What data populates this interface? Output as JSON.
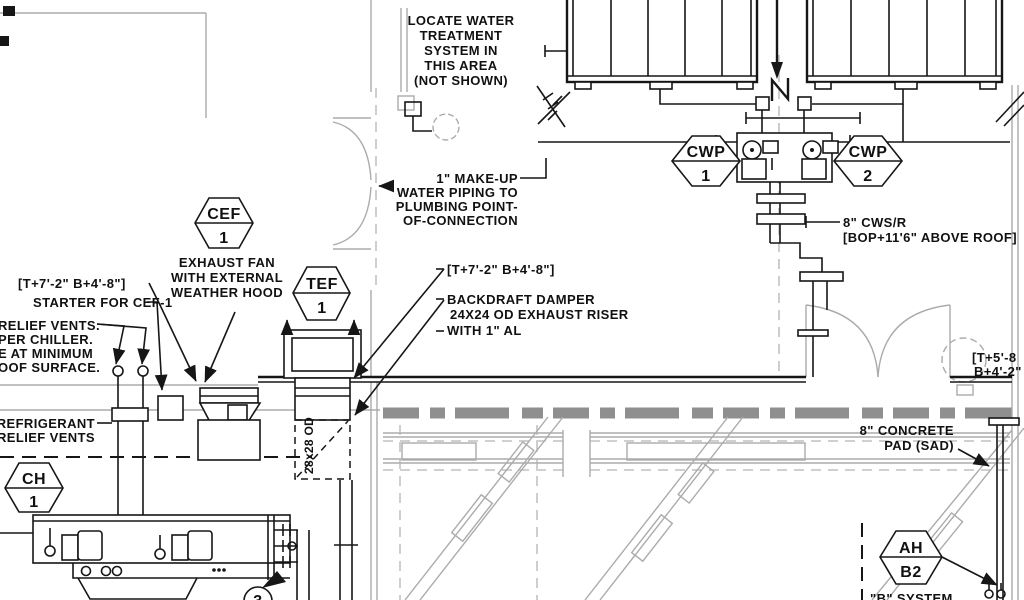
{
  "drawing_type": "mechanical-roof-plan",
  "colors": {
    "ink": "#161616",
    "arch_gray": "#ababab",
    "wall_gray": "#8f8f8f",
    "paper": "#ffffff"
  },
  "notes": {
    "locate": [
      "LOCATE WATER",
      "TREATMENT",
      "SYSTEM IN",
      "THIS AREA",
      "(NOT SHOWN)"
    ],
    "makeup": [
      "1\" MAKE-UP",
      "WATER PIPING TO",
      "PLUMBING POINT-",
      "OF-CONNECTION"
    ],
    "cws": [
      "8\" CWS/R",
      "[BOP+11'6\" ABOVE ROOF]"
    ],
    "coord_left": "[T+7'-2\" B+4'-8\"]",
    "starter": "STARTER FOR CEF-1",
    "relief": [
      "RELIEF VENTS.",
      "PER CHILLER.",
      "E AT MINIMUM",
      "OOF SURFACE."
    ],
    "exhaust_fan": [
      "EXHAUST FAN",
      "WITH EXTERNAL",
      "WEATHER HOOD"
    ],
    "coord_center": "[T+7'-2\" B+4'-8\"]",
    "damper": [
      "BACKDRAFT DAMPER",
      "24X24 OD EXHAUST RISER",
      "WITH 1\" AL"
    ],
    "refrigerant": [
      "' REFRIGERANT",
      "RELIEF VENTS"
    ],
    "riser_size": "28x28 OD",
    "coord_right": [
      "[T+5'-8",
      "B+4'-2\""
    ],
    "concrete": [
      "8\" CONCRETE",
      "PAD (SAD)"
    ],
    "b_system": "\"B\" SYSTEM",
    "keynote_3": "3"
  },
  "tags": {
    "cef": {
      "label": "CEF",
      "number": "1"
    },
    "tef": {
      "label": "TEF",
      "number": "1"
    },
    "cwp1": {
      "label": "CWP",
      "number": "1"
    },
    "cwp2": {
      "label": "CWP",
      "number": "2"
    },
    "ch": {
      "label": "CH",
      "number": "1"
    },
    "ah": {
      "label": "AH",
      "number": "B2"
    }
  }
}
